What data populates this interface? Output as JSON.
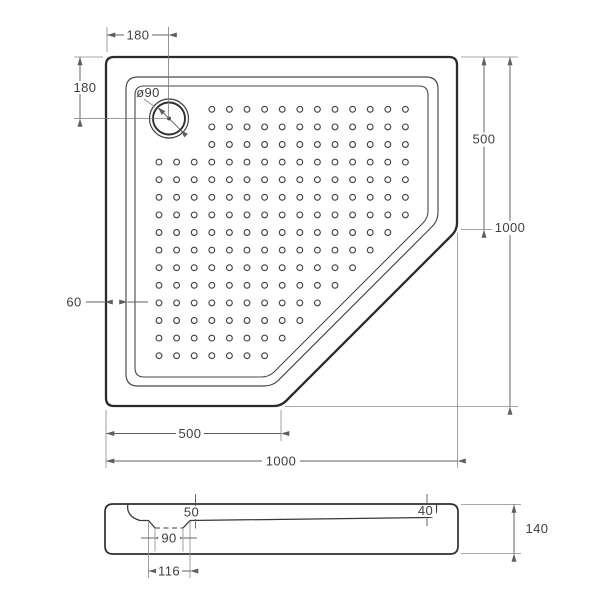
{
  "drawing": {
    "product": "corner shower tray technical drawing",
    "units": "mm",
    "views": {
      "top_view": {
        "overall_width_label": "1000",
        "overall_height_label": "1000",
        "right_edge_straight_label": "500",
        "bottom_edge_straight_label": "500",
        "drain_offset_from_left_label": "180",
        "drain_offset_from_top_label": "180",
        "drain_diameter_label": "ø90",
        "rim_width_label": "60",
        "dot_grid": {
          "cols": 15,
          "rows": 15,
          "origin_x": 159,
          "origin_y": 109.3,
          "spacing": 17.6,
          "radius": 2.9,
          "drain_excluded_cols": 3,
          "drain_excluded_rows": 3,
          "diagonal_limit": 625
        }
      },
      "section_view": {
        "total_height_label": "140",
        "depth_at_drain_label": "50",
        "depth_at_far_end_label": "40",
        "drain_hole_width_label": "90",
        "drain_recess_width_label": "116"
      }
    },
    "colors": {
      "line_dark": "#2b2b2b",
      "line_medium": "#474747",
      "dimension_gray": "#5f5f5f",
      "background": "#ffffff"
    }
  }
}
